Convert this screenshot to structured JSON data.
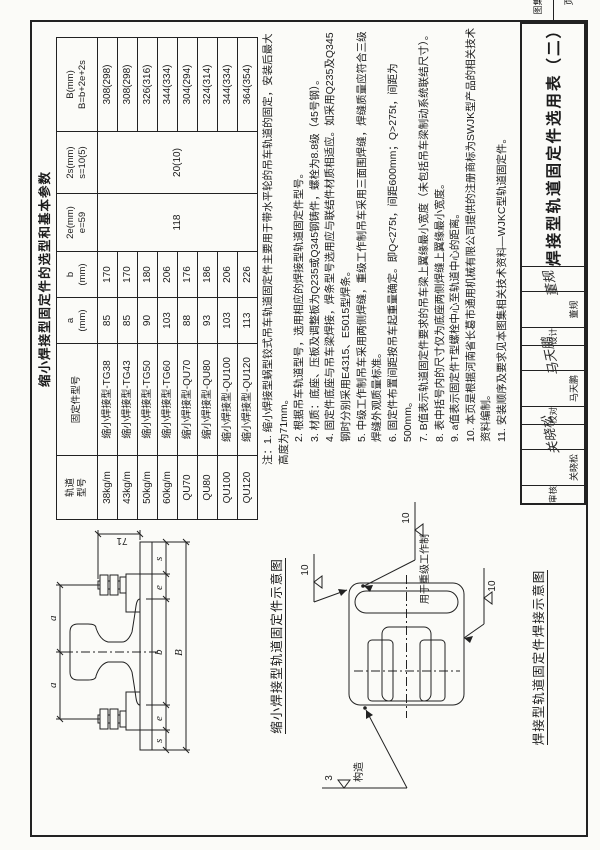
{
  "table": {
    "title": "缩小焊接型固定件的选型和基本参数",
    "headers": {
      "rail_line1": "轨道",
      "rail_line2": "型号",
      "part": "固定件型号",
      "a_line1": "a",
      "a_line2": "(mm)",
      "b_line1": "b",
      "b_line2": "(mm)",
      "e_line1": "2e(mm)",
      "e_line2": "e=59",
      "s_line1": "2s(mm)",
      "s_line2": "s=10(5)",
      "B_line1": "B(mm)",
      "B_line2": "B=b+2e+2s"
    },
    "merged_2e": "118",
    "merged_2s": "20(10)",
    "rows": [
      {
        "rail": "38kg/m",
        "part": "缩小焊接型-TG38",
        "a": "85",
        "b": "170",
        "B": "308(298)"
      },
      {
        "rail": "43kg/m",
        "part": "缩小焊接型-TG43",
        "a": "85",
        "b": "170",
        "B": "308(298)"
      },
      {
        "rail": "50kg/m",
        "part": "缩小焊接型-TG50",
        "a": "90",
        "b": "180",
        "B": "326(316)"
      },
      {
        "rail": "60kg/m",
        "part": "缩小焊接型-TG60",
        "a": "103",
        "b": "206",
        "B": "344(334)"
      },
      {
        "rail": "QU70",
        "part": "缩小焊接型-QU70",
        "a": "88",
        "b": "176",
        "B": "304(294)"
      },
      {
        "rail": "QU80",
        "part": "缩小焊接型-QU80",
        "a": "93",
        "b": "186",
        "B": "324(314)"
      },
      {
        "rail": "QU100",
        "part": "缩小焊接型-QU100",
        "a": "103",
        "b": "206",
        "B": "344(334)"
      },
      {
        "rail": "QU120",
        "part": "缩小焊接型-QU120",
        "a": "113",
        "b": "226",
        "B": "364(354)"
      }
    ]
  },
  "notes": [
    "注：1. 缩小焊接型蜗型铰式吊车轨道固定件主要用于带水平轮的吊车轨道的固定，安装后最大高度为71mm。",
    "2. 根据吊车轨道型号，选用相应的焊接型轨道固定件型号。",
    "3. 材质：底座、压板及调整板为Q235或Q345钢铸件，螺栓为8.8级（45号钢）。",
    "4. 固定件底座与吊车梁焊接，焊条型号选用应与联结件材质相适应。如采用Q235及Q345钢时分别采用E4315、E5015型焊条。",
    "5. 中级工作制吊车采用两侧焊缝，重级工作制吊车采用三面围焊缝，焊缝质量应符合三级焊缝外观质量标准。",
    "6. 固定件布置间距按吊车起重量确定。即Q<275t，间距600mm；Q>275t，间距为500mm。",
    "7. B值表示轨道固定件要求的吊车梁上翼缘最小宽度（未包括吊车梁制动系统联结尺寸）。",
    "8. 表中括号内的尺寸仅为底座两侧焊缝上翼缘最小宽度。",
    "9. a值表示固定件T型螺栓中心至轨道中心的距离。",
    "10. 本页是根据河南省长葛市通用机械有限公司提供的注册商标为SWJK型产品的相关技术资料编制。",
    "11. 安装顺序及要求见本图集相关技术资料—WJKC型轨道固定件。"
  ],
  "cross_section": {
    "caption": "缩小焊接型轨道固定件示意图",
    "dim_71": "71",
    "dim_a": "a",
    "dim_b": "b",
    "dim_e": "e",
    "dim_s": "s",
    "dim_B": "B"
  },
  "plan": {
    "caption": "焊接型轨道固定件焊接示意图",
    "weld_10": "10",
    "weld_3": "3",
    "weld_note": "用于重级工作制",
    "weld_note2": "构造"
  },
  "title_block": {
    "roles": [
      {
        "label": "审核",
        "name": "关晓松",
        "sig": "关晓松"
      },
      {
        "label": "校对",
        "name": "马天鹏",
        "sig": "马天鹏"
      },
      {
        "label": "设计",
        "name": "董规",
        "sig": "董规"
      }
    ],
    "sheet_title": "焊接型轨道固定件选用表（二）",
    "atlas_label": "图集号",
    "atlas_no": "05G525",
    "page_label": "页",
    "page_no": "21"
  }
}
